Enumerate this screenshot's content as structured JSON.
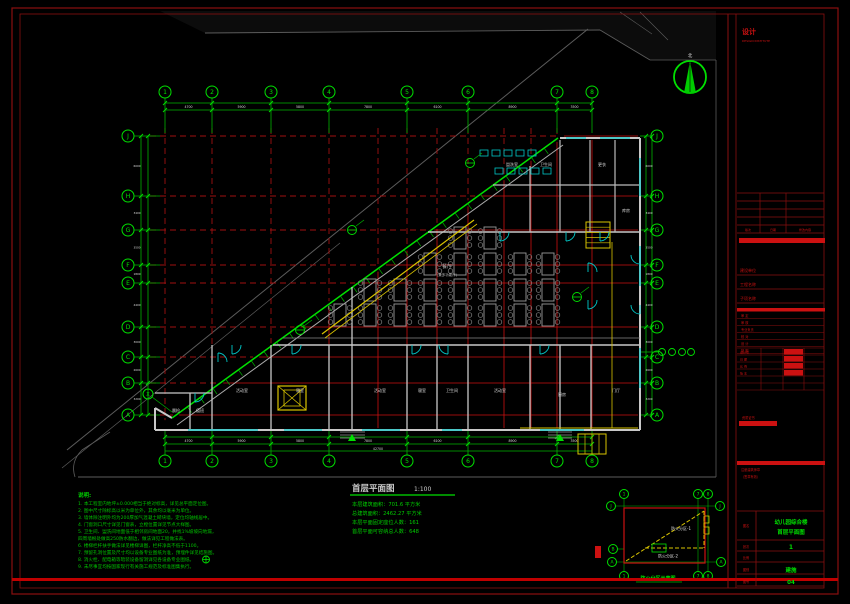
{
  "colors": {
    "green": "#00b400",
    "bright_green": "#00e000",
    "red": "#a01010",
    "bright_red": "#cc1111",
    "dark_red": "#8a0f0f",
    "cyan": "#00c8c8",
    "yellow": "#d9c400",
    "wall_gray": "#c8c8c8",
    "site_gray": "#5c5c5c",
    "white": "#d8d8d8",
    "table_gray": "#979797"
  },
  "north": {
    "label": "北"
  },
  "axes": {
    "numbers": [
      "1",
      "2",
      "3",
      "4",
      "5",
      "6",
      "7",
      "8"
    ],
    "number_x": [
      165,
      212,
      271,
      329,
      407,
      468,
      557,
      592
    ],
    "letters": [
      "J",
      "H",
      "G",
      "F",
      "E",
      "D",
      "C",
      "B",
      "A"
    ],
    "letter_y": [
      136,
      196,
      230,
      265,
      283,
      327,
      357,
      383,
      415
    ],
    "aux": "X"
  },
  "dims": {
    "top": [
      "4700",
      "5900",
      "5800",
      "7800",
      "6100",
      "8900",
      "3500"
    ],
    "bottom": [
      "4700",
      "5900",
      "5800",
      "7800",
      "6100",
      "8900",
      "3500"
    ],
    "left": [
      "6000",
      "3400",
      "3500",
      "1800",
      "4400",
      "3000",
      "2600",
      "3200"
    ],
    "right": [
      "6000",
      "3400",
      "3500",
      "1800",
      "4400",
      "3000",
      "2600",
      "3200"
    ],
    "bottom_total": "42700"
  },
  "plan": {
    "title": "首层平面图",
    "scale": "1:100",
    "area_lines": [
      "本层建筑面积：701.6 平方米",
      "总建筑面积：2462.27 平方米",
      "本层平面固定座位人数：161",
      "首层平面可容纳总人数：648"
    ],
    "hall_label": "餐厅",
    "hall_sub": "(兼多功能厅)",
    "rooms": [
      {
        "t": "晨检",
        "x": 176,
        "y": 412
      },
      {
        "t": "值班",
        "x": 200,
        "y": 412
      },
      {
        "t": "活动室",
        "x": 242,
        "y": 392
      },
      {
        "t": "寝室",
        "x": 300,
        "y": 392
      },
      {
        "t": "活动室",
        "x": 380,
        "y": 392
      },
      {
        "t": "寝室",
        "x": 422,
        "y": 392
      },
      {
        "t": "卫生间",
        "x": 452,
        "y": 392
      },
      {
        "t": "活动室",
        "x": 500,
        "y": 392
      },
      {
        "t": "厨房",
        "x": 562,
        "y": 396
      },
      {
        "t": "门厅",
        "x": 616,
        "y": 392
      },
      {
        "t": "盥洗室",
        "x": 512,
        "y": 166
      },
      {
        "t": "卫生间",
        "x": 546,
        "y": 166
      },
      {
        "t": "更衣",
        "x": 602,
        "y": 166
      },
      {
        "t": "库房",
        "x": 626,
        "y": 212
      }
    ]
  },
  "notes": {
    "header": "说明:",
    "lines": [
      "1. 本工程室内地坪±0.000相当于绝对标高，详见总平面定位图。",
      "2. 图中尺寸除标高以米为单位外，其余均以毫米为单位。",
      "3. 墙体除注明外均为200厚加气混凝土砌块墙，定位均轴线居中。",
      "4. 门窗洞口尺寸详见门窗表，立樘位置详见节点大样图。",
      "5. 卫生间、盥洗间地面低于相邻房间地面20，并找1%坡坡向地漏，",
      "    四周墙根处做高250防水翻边，做法详见工程做法表。",
      "6. 楼梯栏杆扶手做法详见楼梯详图，栏杆净高不低于1100。",
      "7. 预留孔洞位置及尺寸均以设备专业图纸为准，预埋件详见结施图。",
      "8. 消火栓、配电箱等暗装设备留洞详见各设备专业图纸。",
      "9. 未尽事宜均按国家现行有关施工规范及标准图集执行。"
    ]
  },
  "fire": {
    "caption": "防火分区示意图",
    "zone1": "防火分区-1",
    "zone2": "防火分区-2",
    "bubbles_top": [
      "1",
      "7",
      "8"
    ],
    "bubbles_bottom": [
      "1",
      "7",
      "8"
    ],
    "bubbles_left": [
      "J",
      "B",
      "A"
    ],
    "bubbles_right": [
      "J",
      "A"
    ]
  },
  "title_block": {
    "logo": "设计",
    "logo_sub": "DESIGN INSTITUTE",
    "rev_cols": [
      "版次",
      "日期",
      "修改内容"
    ],
    "fields": [
      "建设单位",
      "工程名称",
      "子项名称"
    ],
    "sign_rows": [
      "审 定",
      "审 核",
      "专业负责",
      "校 对",
      "设 计",
      "制 图"
    ],
    "grid_labels": [
      "设计号",
      "日 期",
      "比 例",
      "版 本"
    ],
    "attest_label": "资质证书",
    "seal_line1": "注册建筑师章",
    "seal_line2": "（签章有效）",
    "rows": {
      "name_label": "图名",
      "name_value1": "幼儿园综合楼",
      "name_value2": "首层平面图",
      "count_label": "张次",
      "count_value": "1",
      "scale_label": "比例",
      "scale_value": "",
      "stage_label": "图别",
      "stage_value": "建施",
      "no_label": "图号",
      "no_value": "04"
    }
  }
}
